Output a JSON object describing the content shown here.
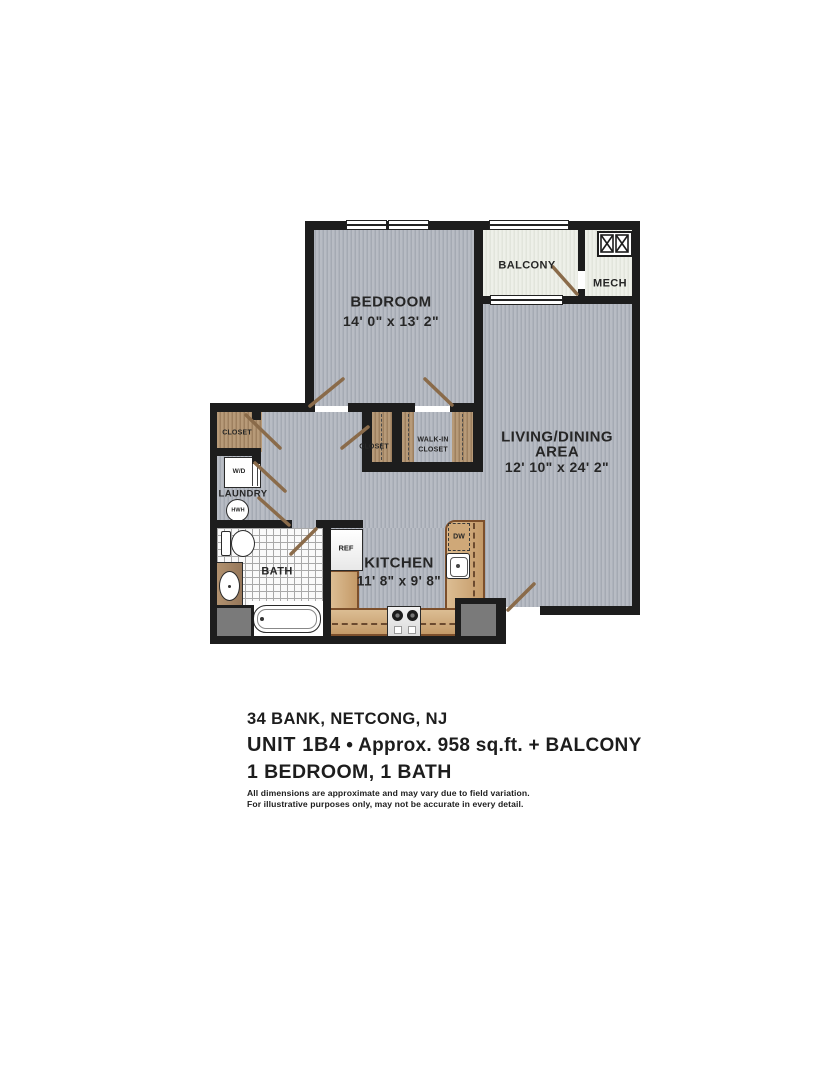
{
  "floorplan": {
    "rooms": {
      "bedroom": {
        "name": "BEDROOM",
        "dims": "14' 0\" x 13' 2\""
      },
      "living": {
        "name_line1": "LIVING/DINING",
        "name_line2": "AREA",
        "dims": "12' 10\" x 24' 2\""
      },
      "kitchen": {
        "name": "KITCHEN",
        "dims": "11' 8\" x 9' 8\""
      },
      "bath": {
        "name": "BATH"
      },
      "laundry": {
        "name": "LAUNDRY"
      },
      "balcony": {
        "name": "BALCONY"
      },
      "mech": {
        "name": "MECH"
      },
      "closet_hall": {
        "name": "CLOSET"
      },
      "closet_mid": {
        "name": "CLOSET"
      },
      "walkin_closet": {
        "line1": "WALK-IN",
        "line2": "CLOSET"
      }
    },
    "fixtures": {
      "washer_dryer": "W/D",
      "water_heater": "HWH",
      "refrigerator": "REF",
      "dishwasher": "DW"
    },
    "colors": {
      "wall": "#1d1d1d",
      "carpet": "#b8bcc4",
      "wood": "#b79a78",
      "counter": "#c49a68",
      "patio": "#eef0e9"
    }
  },
  "footer": {
    "address": "34 BANK, NETCONG, NJ",
    "unit": "UNIT 1B4",
    "unit_rest": " • Approx. 958 sq.ft. + BALCONY",
    "config": "1 BEDROOM, 1 BATH",
    "disclaimer1": "All dimensions are approximate and may vary due to field variation.",
    "disclaimer2": "For illustrative purposes only, may not be accurate in every detail."
  }
}
